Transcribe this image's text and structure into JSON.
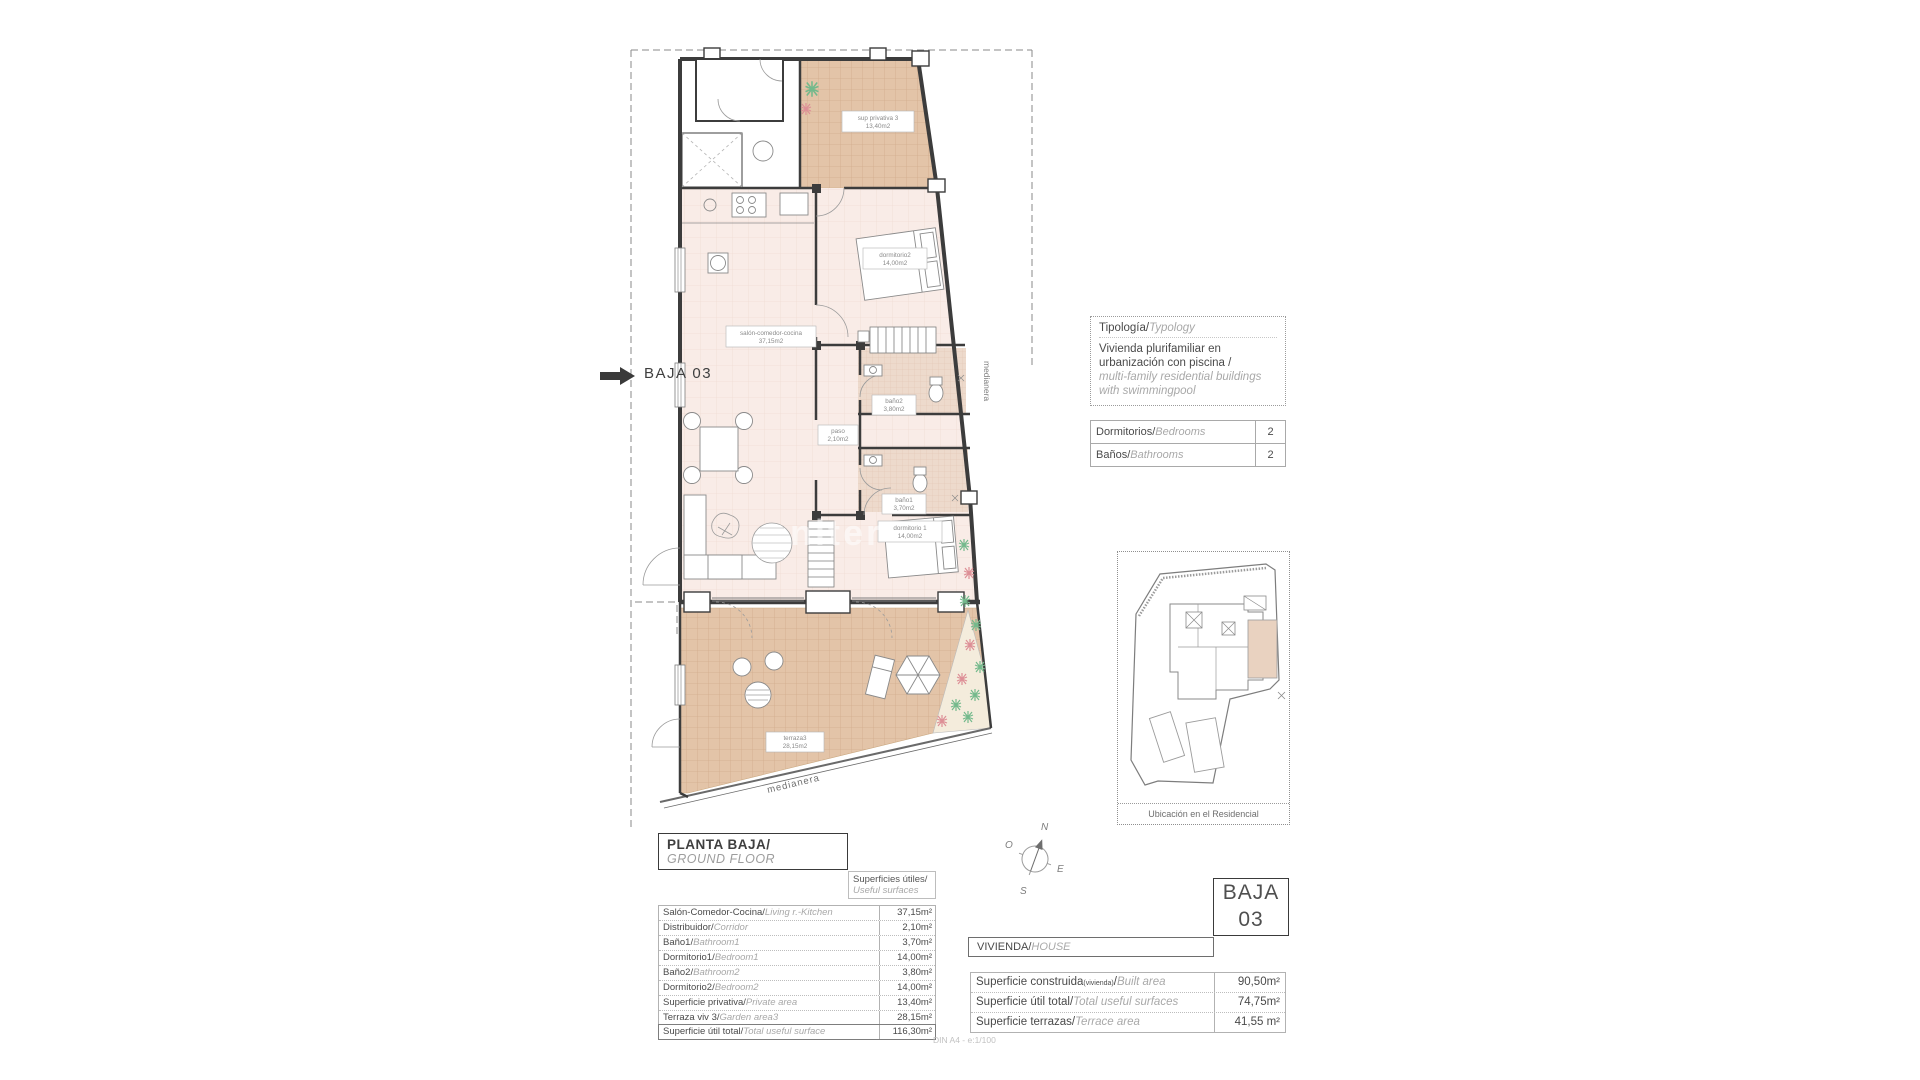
{
  "indicator": {
    "label": "BAJA 03"
  },
  "plan": {
    "rooms": [
      {
        "name": "sup privativa 3",
        "area": "13,40m2"
      },
      {
        "name": "dormitorio2",
        "area": "14,00m2"
      },
      {
        "name": "salón-comedor-cocina",
        "area": "37,15m2"
      },
      {
        "name": "paso",
        "area": "2,10m2"
      },
      {
        "name": "baño2",
        "area": "3,80m2"
      },
      {
        "name": "baño1",
        "area": "3,70m2"
      },
      {
        "name": "dormitorio 1",
        "area": "14,00m2"
      },
      {
        "name": "terraza3",
        "area": "28,15m2"
      }
    ],
    "party_wall_label_right": "medianera",
    "party_wall_label_bottom": "medianera",
    "watermark": "niter"
  },
  "compass": {
    "north": "N",
    "south": "S",
    "east": "E",
    "west": "O"
  },
  "typology": {
    "title_es": "Tipología/",
    "title_en": "Typology",
    "body_es": "Vivienda plurifamiliar en urbanización con piscina  /",
    "body_en": "multi-family residential buildings with swimmingpool"
  },
  "counts": {
    "rows": [
      {
        "es": "Dormitorios/",
        "en": "Bedrooms",
        "value": "2"
      },
      {
        "es": "Baños/",
        "en": "Bathrooms",
        "value": "2"
      }
    ]
  },
  "location_plan": {
    "caption": "Ubicación en el Residencial"
  },
  "title_box": {
    "es": "PLANTA BAJA/",
    "en": "GROUND FLOOR"
  },
  "surfaces_header": {
    "es": "Superficies útiles/",
    "en": "Useful surfaces"
  },
  "surfaces_table": {
    "rows": [
      {
        "es": "Salón-Comedor-Cocina/",
        "en": "Living r.-Kitchen",
        "value": "37,15m²"
      },
      {
        "es": "Distribuidor/",
        "en": "Corridor",
        "value": "2,10m²"
      },
      {
        "es": "Baño1/",
        "en": "Bathroom1",
        "value": "3,70m²"
      },
      {
        "es": "Dormitorio1/",
        "en": "Bedroom1",
        "value": "14,00m²"
      },
      {
        "es": "Baño2/",
        "en": "Bathroom2",
        "value": "3,80m²"
      },
      {
        "es": "Dormitorio2/",
        "en": "Bedroom2",
        "value": "14,00m²"
      },
      {
        "es": "Superficie privativa/",
        "en": "Private area",
        "value": "13,40m²"
      },
      {
        "es": "Terraza viv 3/",
        "en": "Garden area3",
        "value": "28,15m²"
      },
      {
        "es": "Superficie útil total/",
        "en": "Total useful surface",
        "value": "116,30m²"
      }
    ]
  },
  "unit_box": {
    "line1": "BAJA",
    "line2": "03"
  },
  "vivienda_header": {
    "es": "VIVIENDA/",
    "en": "HOUSE"
  },
  "totals_table": {
    "rows": [
      {
        "es": "Superficie construida",
        "es_small": "(vivienda)",
        "slash": "/",
        "en": "Built area",
        "value": "90,50m²"
      },
      {
        "es": "Superficie útil total",
        "es_small": "",
        "slash": "/",
        "en": "Total useful surfaces",
        "value": "74,75m²"
      },
      {
        "es": "Superficie terrazas",
        "es_small": "",
        "slash": "/",
        "en": "Terrace area",
        "value": "41,55 m²"
      }
    ]
  },
  "scale_note": "DIN A4 - e:1/100",
  "colors": {
    "tile": "#e3c4a8",
    "tile_line": "#d2ad8c",
    "floor": "#f9ece7",
    "floor_line": "#f0dcd4",
    "bath": "#eddacc",
    "bath_line": "#dfc4b0",
    "wall": "#3c3c3c",
    "accent_green": "#74b98c",
    "accent_red": "#dd8f96",
    "highlight": "#e9d2c0"
  }
}
